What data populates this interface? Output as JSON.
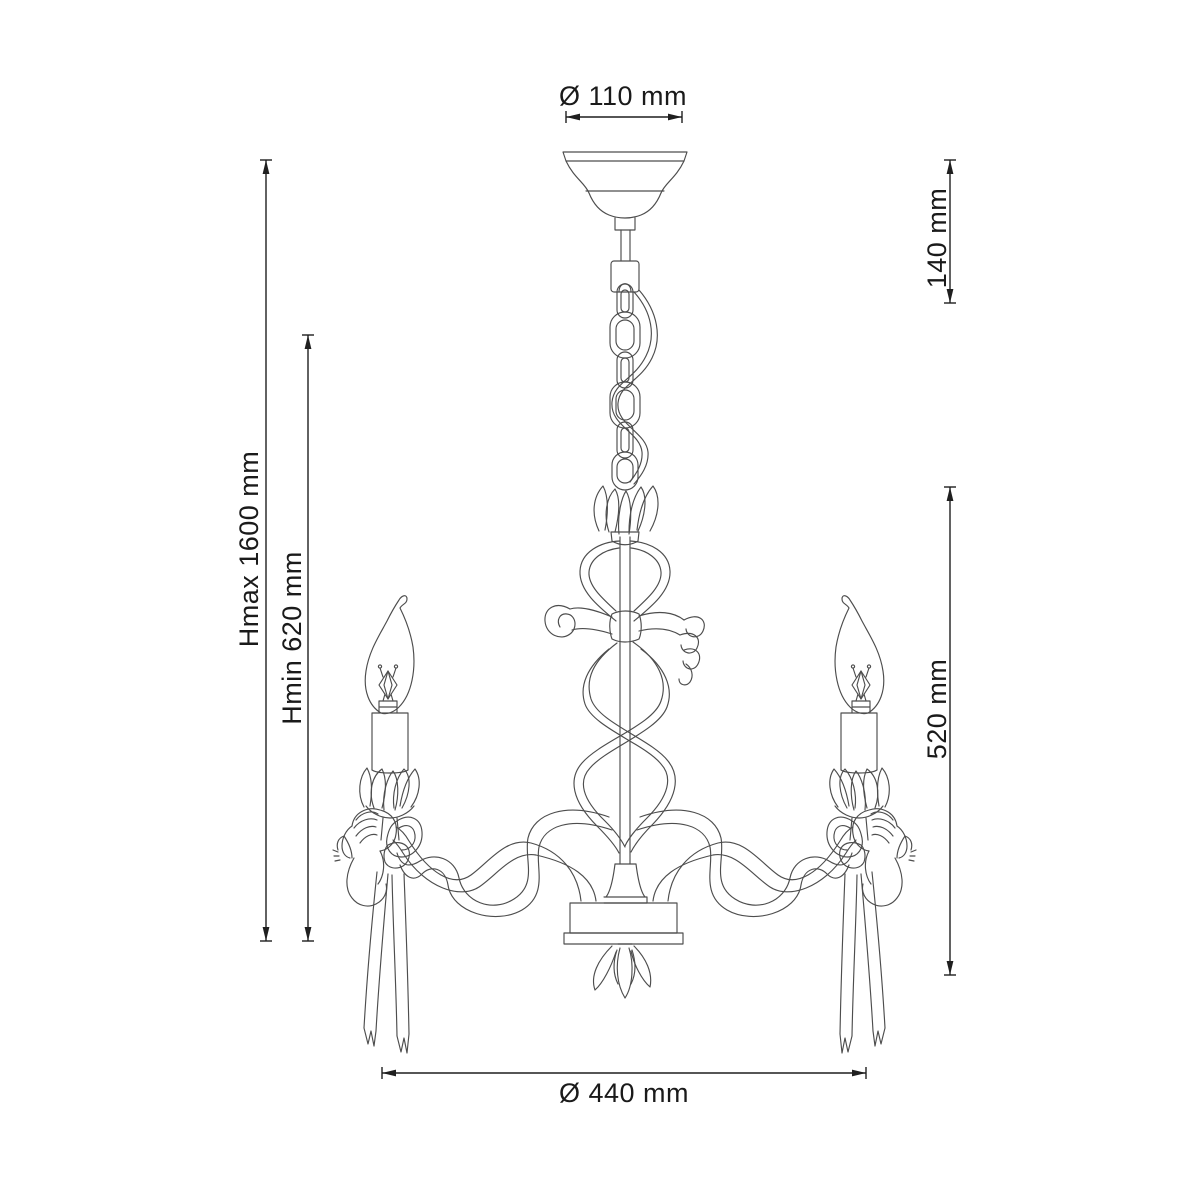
{
  "meta": {
    "type": "technical-dimension-drawing",
    "subject": "three-arm cherub chandelier with candle bulbs and ribbon ornaments"
  },
  "style": {
    "background": "#ffffff",
    "art_line_color": "#4d4d4d",
    "dimension_line_color": "#1f1f1f",
    "text_color": "#1a1a1a"
  },
  "dimensions": {
    "canopy_diameter": {
      "label": "Ø 110 mm"
    },
    "canopy_section_height": {
      "label": "140 mm"
    },
    "height_max": {
      "label": "Hmax 1600 mm"
    },
    "height_min": {
      "label": "Hmin 620 mm"
    },
    "body_height": {
      "label": "520 mm"
    },
    "body_diameter": {
      "label": "Ø 440 mm"
    }
  },
  "figure_parts": [
    "ceiling-canopy",
    "suspension-rod",
    "chain",
    "power-cable",
    "tulip-ornament",
    "heart-ornament",
    "ribbon-bow",
    "spiral-ribbons",
    "center-stem",
    "hub-drum",
    "leaf-finial",
    "arm",
    "arm-ribbon",
    "cherub-figure",
    "ribbon-tails",
    "bobeche",
    "candle-sleeve",
    "flame-bulb"
  ]
}
